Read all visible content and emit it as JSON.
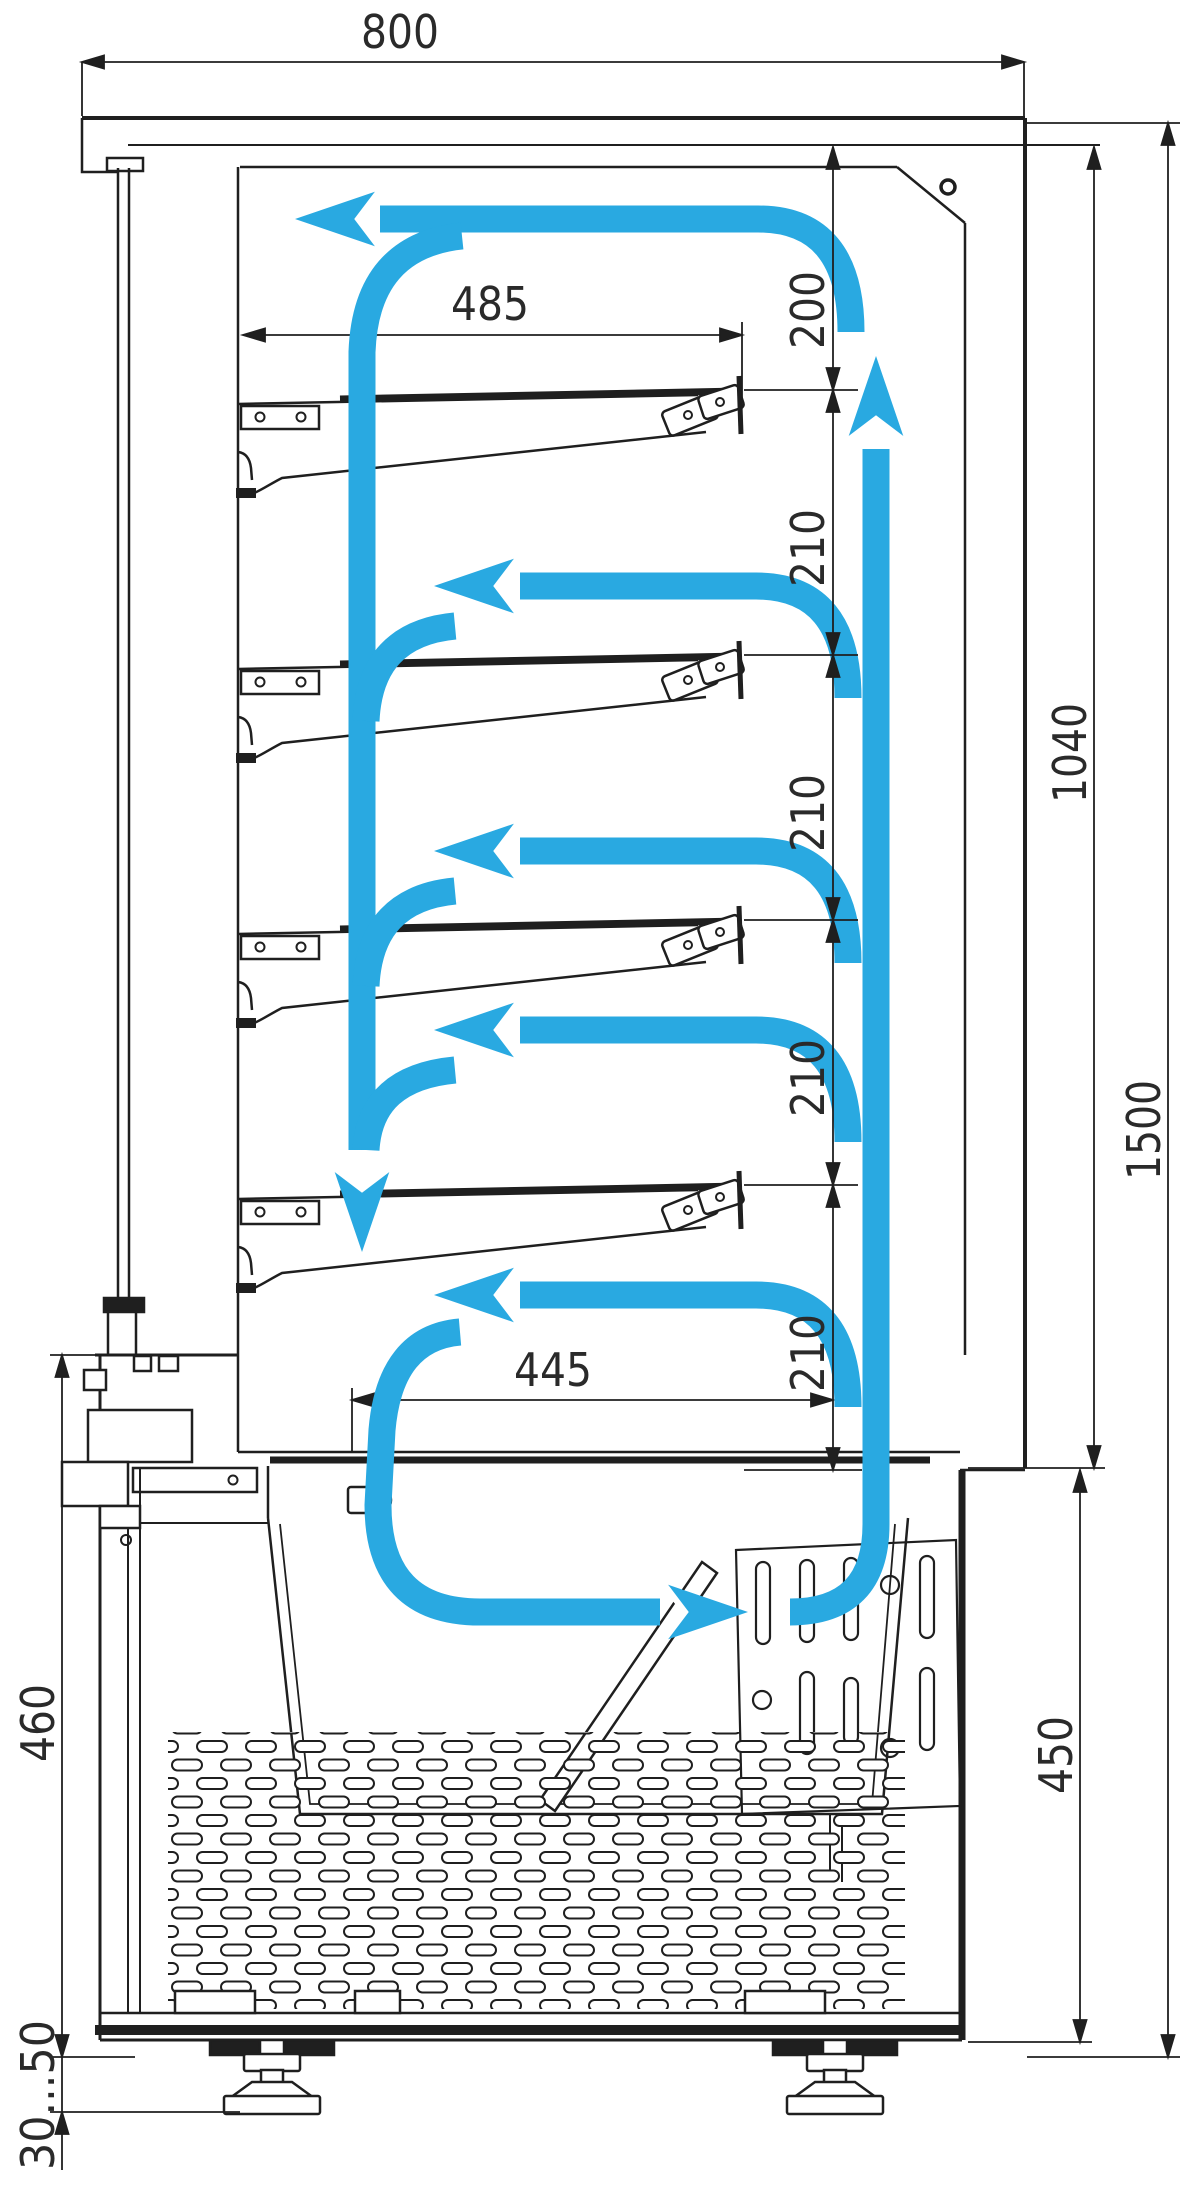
{
  "diagram": {
    "type": "technical-drawing-side-section",
    "accent_color": "#29a9e1",
    "line_color": "#1f1f1f",
    "shelf_count": 4,
    "dimensions": {
      "depth_overall": "800",
      "shelf_length": "485",
      "top_clearance": "200",
      "shelf_gap_1": "210",
      "shelf_gap_2": "210",
      "shelf_gap_3": "210",
      "shelf_gap_4": "210",
      "display_height": "1040",
      "overall_height": "1500",
      "base_opening": "445",
      "base_front_height": "460",
      "base_rear_height": "450",
      "foot_adjustment": "30...50"
    }
  }
}
